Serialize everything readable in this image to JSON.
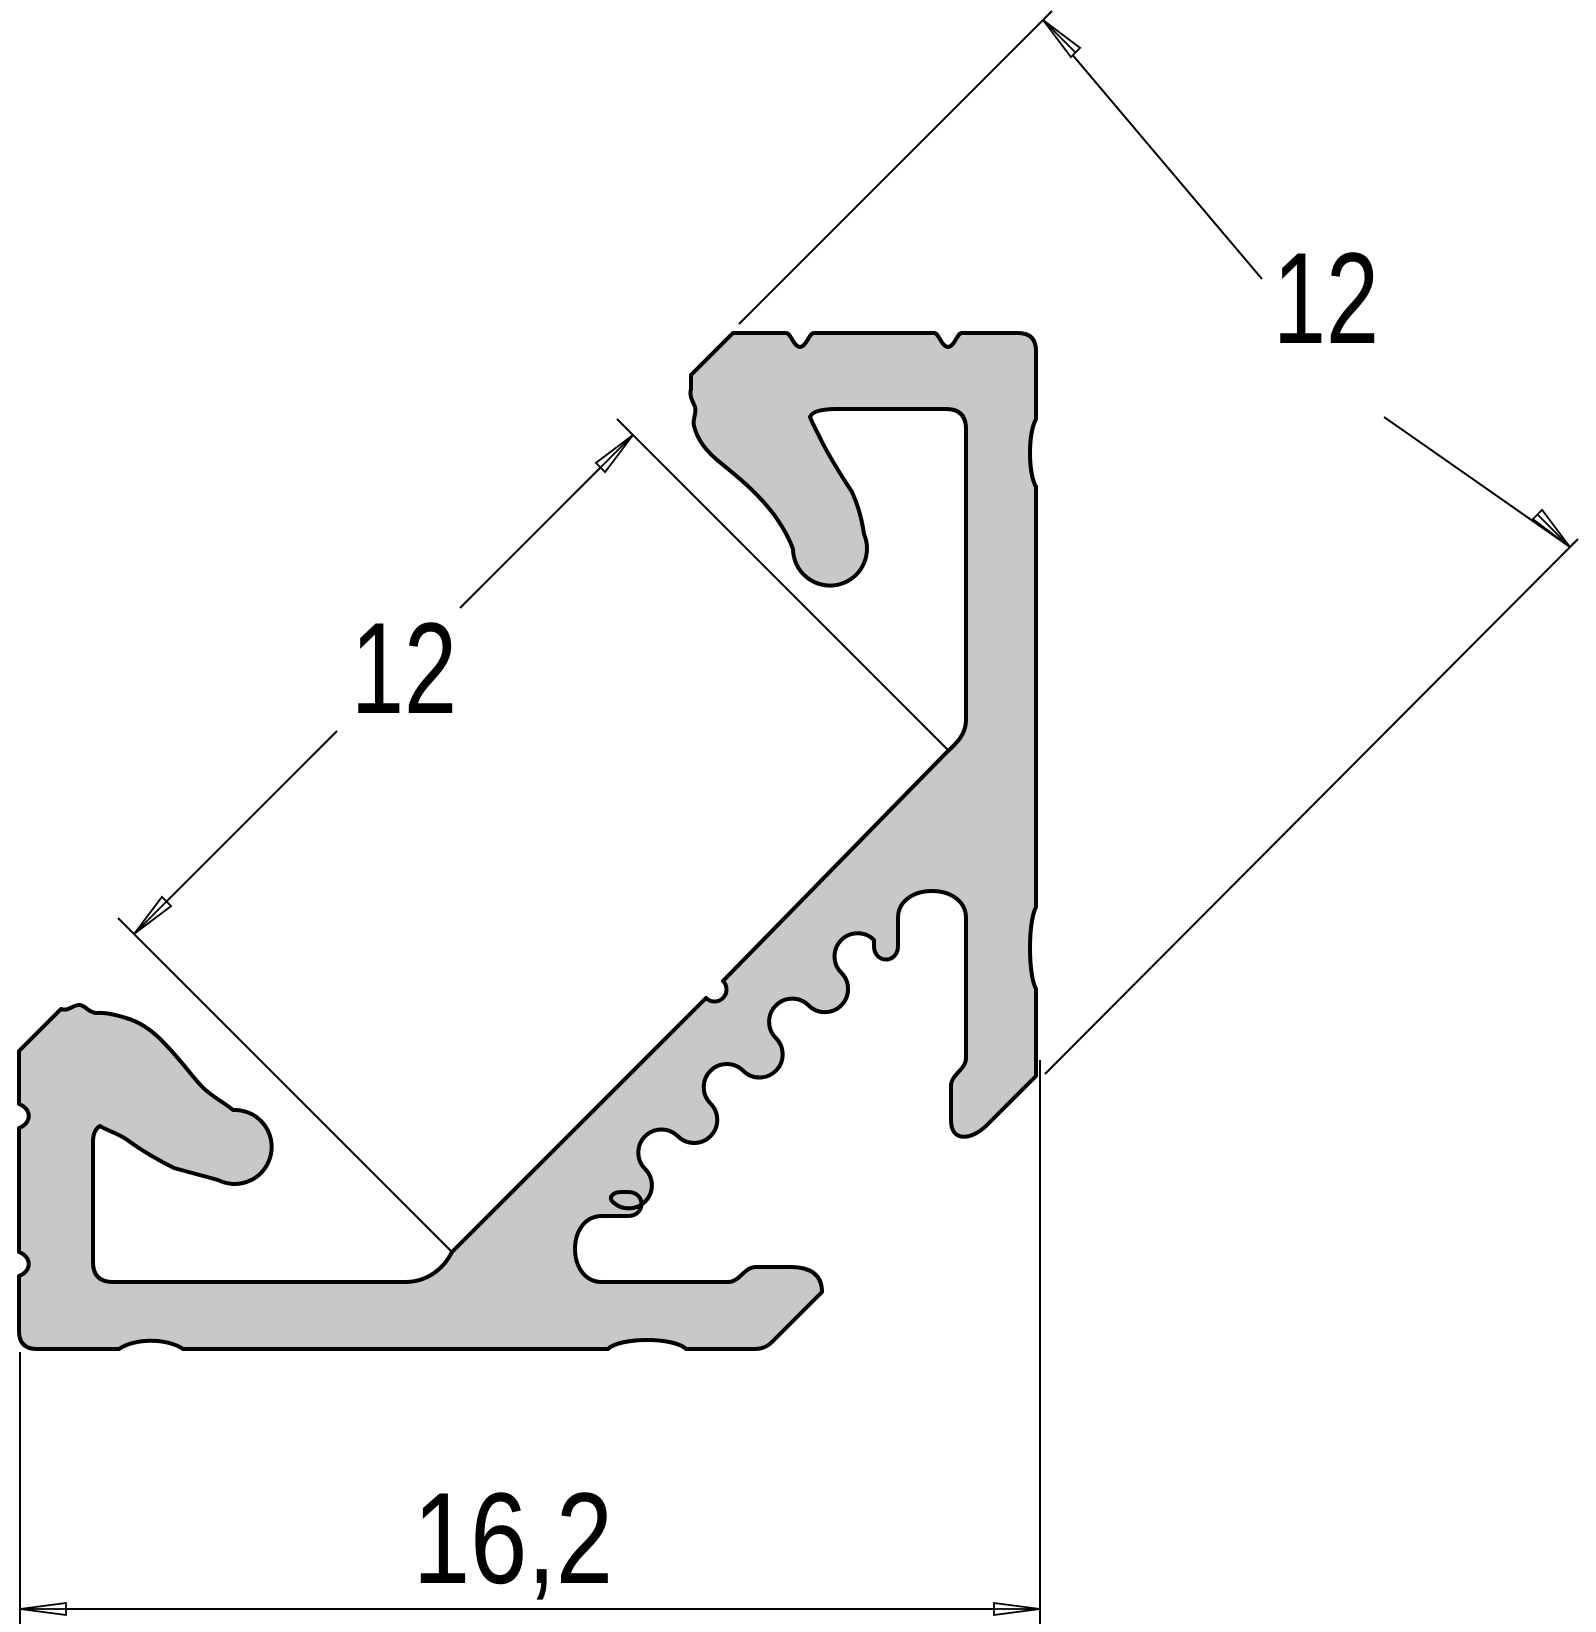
{
  "drawing": {
    "dimensions": {
      "leg_top_right": {
        "value": "12"
      },
      "channel_face_left": {
        "value": "12"
      },
      "overall_width_bottom": {
        "value": "16,2"
      }
    },
    "colors": {
      "profile_fill": "#c8c8c8",
      "line": "#000000",
      "background": "#ffffff"
    }
  }
}
